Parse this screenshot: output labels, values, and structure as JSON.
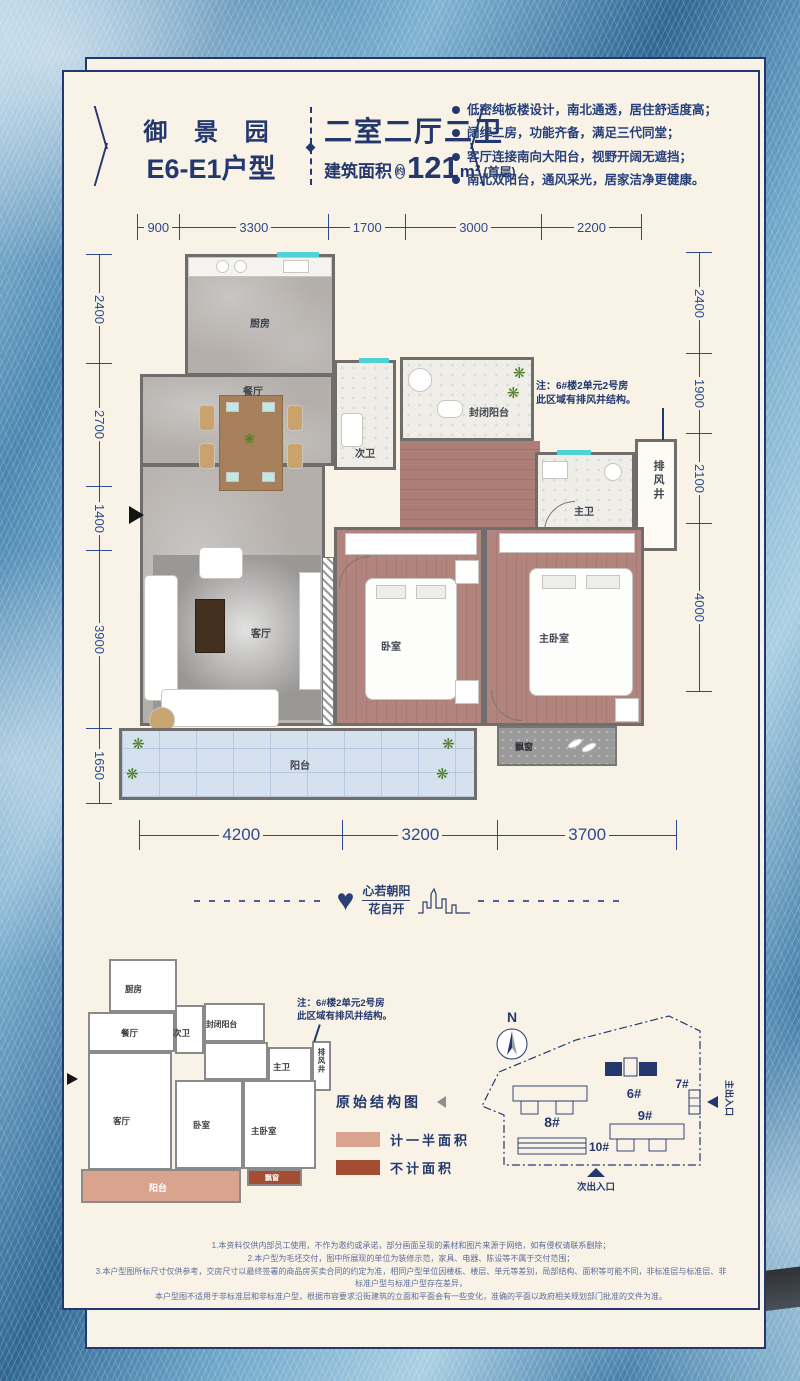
{
  "header": {
    "project_name": "御 景 园",
    "unit_name": "E6-E1户型",
    "layout_title": "二室二厅二卫",
    "area_prefix": "建筑面积",
    "area_circle": "约",
    "area_value": "121",
    "area_unit": "m²",
    "area_floor": "(首层)",
    "features": [
      "低密纯板楼设计，南北通透，居住舒适度高；",
      "阔绰二房，功能齐备，满足三代同堂；",
      "客厅连接南向大阳台，视野开阔无遮挡；",
      "南北双阳台，通风采光，居家洁净更健康。"
    ]
  },
  "dimensions": {
    "top": [
      "900",
      "3300",
      "1700",
      "3000",
      "2200"
    ],
    "left": [
      "2400",
      "2700",
      "1400",
      "3900",
      "1650"
    ],
    "right": [
      "2400",
      "1900",
      "2100",
      "4000"
    ],
    "bottom": [
      "4200",
      "3200",
      "3700"
    ]
  },
  "plan": {
    "rooms": {
      "kitchen": "厨房",
      "dining": "餐厅",
      "second_bath": "次卫",
      "enclosed_balcony": "封闭阳台",
      "exhaust_shaft": "排风井",
      "master_bath": "主卫",
      "living": "客厅",
      "bedroom": "卧室",
      "master_bedroom": "主卧室",
      "balcony": "阳台",
      "bay_window": "飘窗"
    },
    "note_line1": "注：6#楼2单元2号房",
    "note_line2": "此区域有排风井结构。"
  },
  "slogan": {
    "line1": "心若朝阳",
    "line2": "花自开"
  },
  "original_structure": {
    "title": "原始结构图"
  },
  "legend": [
    {
      "label": "计一半面积",
      "color": "#d9a38d"
    },
    {
      "label": "不计面积",
      "color": "#a34e33"
    }
  ],
  "site_plan": {
    "north": "N",
    "buildings": {
      "b6": "6#",
      "b7": "7#",
      "b8": "8#",
      "b9": "9#",
      "b10": "10#"
    },
    "main_entrance": "主出入口",
    "secondary_entrance": "次出入口"
  },
  "disclaimer": [
    "1.本资料仅供内部员工使用，不作为邀约或承诺，部分画面呈现的素材和图片来源于网络，如有侵权请联系删除；",
    "2.本户型为毛坯交付，图中所展现的单位为装修示范，家具、电器、陈设等不属于交付范围；",
    "3.本户型图所标尺寸仅供参考，交房尺寸以最终签署的商品房买卖合同的约定为准，相同户型单位因楼栋、楼层、单元等差别，局部结构、面积等可能不同，非标准层与标准层、非标准户型与标准户型存在差异，",
    "本户型图不适用于非标准层和非标准户型，根据市容要求沿街建筑的立面和平面会有一些变化，准确的平面以政府相关规划部门批准的文件为准。"
  ],
  "colors": {
    "card_bg": "#f8f3e6",
    "accent_navy": "#24386e",
    "dim_blue": "#2c4a8d",
    "wall_gray": "#6f6e6c",
    "marble_gray": "#b4afab",
    "wood_red": "#b2847e",
    "balcony_blue": "#d6e1ef",
    "tile_white": "#efede7",
    "window_teal": "#4ed2d6",
    "legend_half": "#d9a38d",
    "legend_excluded": "#a34e33",
    "background_blue": "#5d96bd"
  }
}
